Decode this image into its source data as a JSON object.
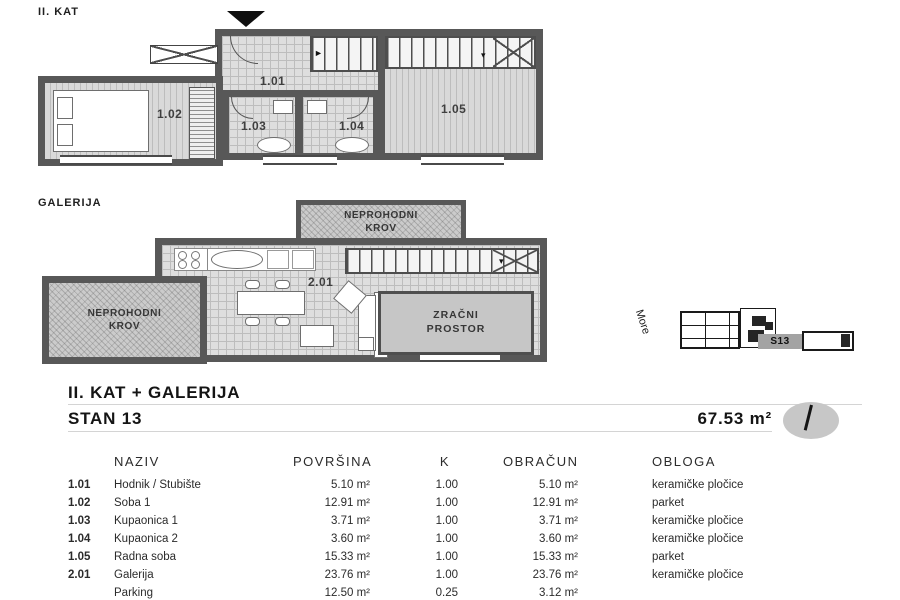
{
  "upper_plan": {
    "label": "II. KAT",
    "rooms": {
      "r101": "1.01",
      "r102": "1.02",
      "r103": "1.03",
      "r104": "1.04",
      "r105": "1.05"
    }
  },
  "gallery_plan": {
    "label": "GALERIJA",
    "room": "2.01",
    "roof_line1": "NEPROHODNI",
    "roof_line2": "KROV",
    "air_line1": "ZRAČNI",
    "air_line2": "PROSTOR"
  },
  "site_plan": {
    "sea": "More",
    "unit": "S13"
  },
  "header": {
    "title": "II. KAT + GALERIJA",
    "subtitle": "STAN 13",
    "total_area": "67.53 m²"
  },
  "table": {
    "headers": {
      "naziv": "NAZIV",
      "povrsina": "POVRŠINA",
      "k": "K",
      "obracun": "OBRAČUN",
      "obloga": "OBLOGA"
    },
    "rows": [
      {
        "num": "1.01",
        "name": "Hodnik / Stubište",
        "area": "5.10 m²",
        "k": "1.00",
        "calc": "5.10 m²",
        "finish": "keramičke pločice"
      },
      {
        "num": "1.02",
        "name": "Soba 1",
        "area": "12.91 m²",
        "k": "1.00",
        "calc": "12.91 m²",
        "finish": "parket"
      },
      {
        "num": "1.03",
        "name": "Kupaonica 1",
        "area": "3.71 m²",
        "k": "1.00",
        "calc": "3.71 m²",
        "finish": "keramičke pločice"
      },
      {
        "num": "1.04",
        "name": "Kupaonica 2",
        "area": "3.60 m²",
        "k": "1.00",
        "calc": "3.60 m²",
        "finish": "keramičke pločice"
      },
      {
        "num": "1.05",
        "name": "Radna soba",
        "area": "15.33 m²",
        "k": "1.00",
        "calc": "15.33 m²",
        "finish": "parket"
      },
      {
        "num": "2.01",
        "name": "Galerija",
        "area": "23.76 m²",
        "k": "1.00",
        "calc": "23.76 m²",
        "finish": "keramičke pločice"
      },
      {
        "num": "",
        "name": "Parking",
        "area": "12.50 m²",
        "k": "0.25",
        "calc": "3.12 m²",
        "finish": ""
      }
    ]
  },
  "colors": {
    "wall": "#585858",
    "floor_light": "#dedede",
    "highlight_grey": "#a3a3a3"
  }
}
